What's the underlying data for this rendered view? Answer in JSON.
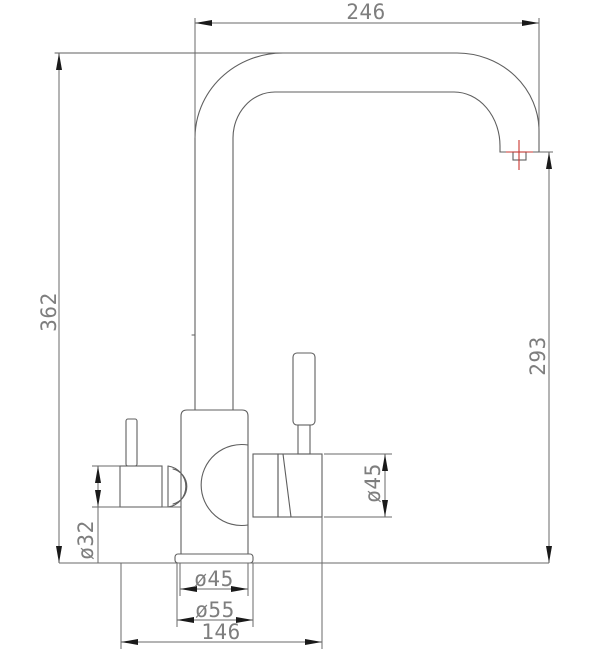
{
  "drawing": {
    "type": "technical-dimension-drawing",
    "subject": "two-handle kitchen faucet, side elevation",
    "colors": {
      "line": "#5f5f5f",
      "dimension": "#6a6a6a",
      "arrow": "#1a1a1a",
      "text": "#7e7e7e",
      "accent": "#c9342f",
      "background": "#ffffff"
    },
    "labels": {
      "spout_reach": "246",
      "overall_height": "362",
      "spout_outlet_height": "293",
      "right_valve_diameter": "ø45",
      "left_valve_diameter": "ø32",
      "mounting_neck_diameter": "ø45",
      "base_flange_diameter": "ø55",
      "valve_span_width": "146"
    }
  }
}
